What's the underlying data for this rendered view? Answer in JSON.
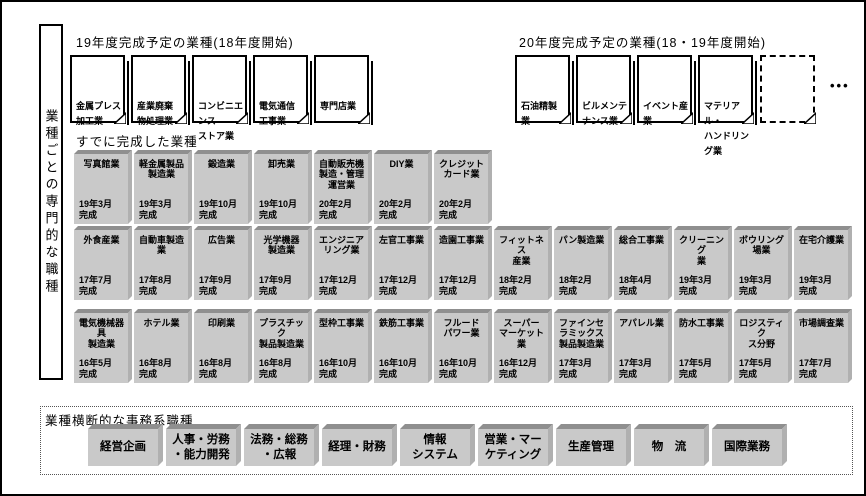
{
  "sidebar": {
    "label": "業種ごとの専門的な職種"
  },
  "planned19": {
    "title": "19年度完成予定の業種(18年度開始)",
    "cards": [
      "金属プレス\n加工業",
      "産業廃棄\n物処理業",
      "コンビニエンス\nストア業",
      "電気通信\n工事業",
      "専門店業"
    ]
  },
  "planned20": {
    "title": "20年度完成予定の業種(18・19年度開始)",
    "cards": [
      "石油精製\n業",
      "ビルメンテ\nナンス業",
      "イベント産業",
      "マテリアル・\nハンドリング業"
    ],
    "more": "•••"
  },
  "completed": {
    "title": "すでに完成した業種",
    "rows": [
      [
        {
          "name": "写真館業",
          "date": "19年3月\n完成"
        },
        {
          "name": "軽金属製品\n製造業",
          "date": "19年3月\n完成"
        },
        {
          "name": "鍛造業",
          "date": "19年10月\n完成"
        },
        {
          "name": "卸売業",
          "date": "19年10月\n完成"
        },
        {
          "name": "自動販売機\n製造・管理\n運営業",
          "date": "20年2月\n完成"
        },
        {
          "name": "DIY業",
          "date": "20年2月\n完成"
        },
        {
          "name": "クレジット\nカード業",
          "date": "20年2月\n完成"
        }
      ],
      [
        {
          "name": "外食産業",
          "date": "17年7月\n完成"
        },
        {
          "name": "自動車製造\n業",
          "date": "17年8月\n完成"
        },
        {
          "name": "広告業",
          "date": "17年9月\n完成"
        },
        {
          "name": "光学機器\n製造業",
          "date": "17年9月\n完成"
        },
        {
          "name": "エンジニア\nリング業",
          "date": "17年12月\n完成"
        },
        {
          "name": "左官工事業",
          "date": "17年12月\n完成"
        },
        {
          "name": "造園工事業",
          "date": "17年12月\n完成"
        },
        {
          "name": "フィットネス\n産業",
          "date": "18年2月\n完成"
        },
        {
          "name": "パン製造業",
          "date": "18年2月\n完成"
        },
        {
          "name": "総合工事業",
          "date": "18年4月\n完成"
        },
        {
          "name": "クリーニング\n業",
          "date": "19年3月\n完成"
        },
        {
          "name": "ボウリング\n場業",
          "date": "19年3月\n完成"
        },
        {
          "name": "在宅介護業",
          "date": "19年3月\n完成"
        }
      ],
      [
        {
          "name": "電気機械器具\n製造業",
          "date": "16年5月\n完成"
        },
        {
          "name": "ホテル業",
          "date": "16年8月\n完成"
        },
        {
          "name": "印刷業",
          "date": "16年8月\n完成"
        },
        {
          "name": "プラスチック\n製品製造業",
          "date": "16年8月\n完成"
        },
        {
          "name": "型枠工事業",
          "date": "16年10月\n完成"
        },
        {
          "name": "鉄筋工事業",
          "date": "16年10月\n完成"
        },
        {
          "name": "フルード\nパワー業",
          "date": "16年10月\n完成"
        },
        {
          "name": "スーパー\nマーケット業",
          "date": "16年12月\n完成"
        },
        {
          "name": "ファインセラミックス\n製品製造業",
          "date": "17年3月\n完成"
        },
        {
          "name": "アパレル業",
          "date": "17年3月\n完成"
        },
        {
          "name": "防水工事業",
          "date": "17年5月\n完成"
        },
        {
          "name": "ロジスティク\nス分野",
          "date": "17年5月\n完成"
        },
        {
          "name": "市場調査業",
          "date": "17年7月\n完成"
        }
      ]
    ]
  },
  "office": {
    "title": "業種横断的な事務系職種",
    "items": [
      "経営企画",
      "人事・労務\n・能力開発",
      "法務・総務\n・広報",
      "経理・財務",
      "情報\nシステム",
      "営業・マー\nケティング",
      "生産管理",
      "物　流",
      "国際業務"
    ]
  },
  "colors": {
    "box_face": "#c9c9c9",
    "box_top": "#8f8f8f",
    "box_side": "#b0b0b0",
    "border": "#000000"
  }
}
